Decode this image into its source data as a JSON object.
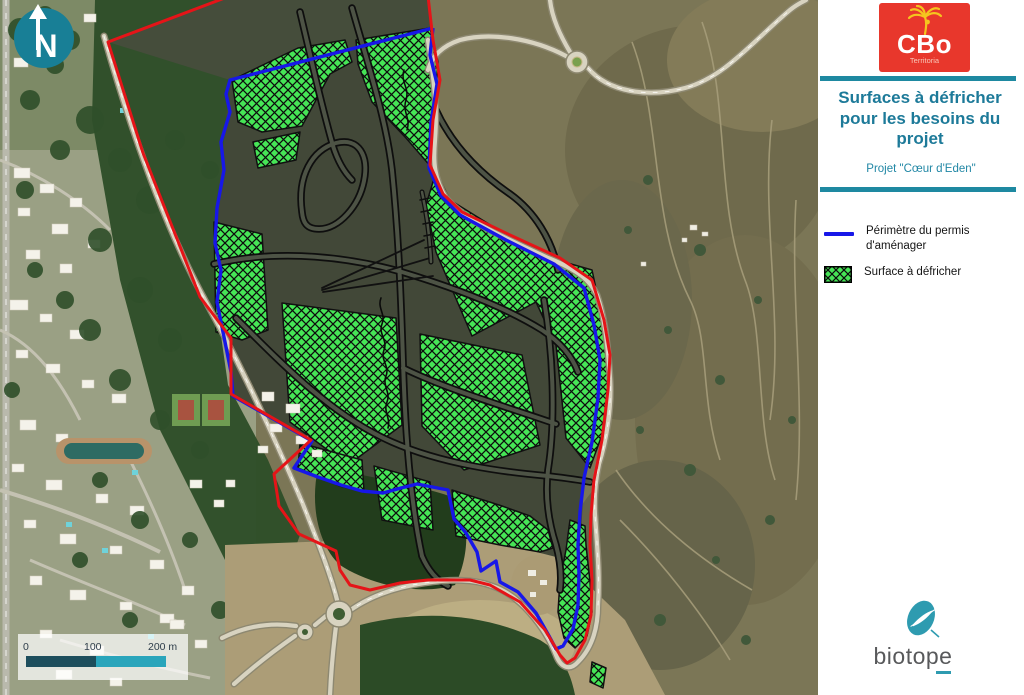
{
  "map": {
    "north_label": "N",
    "scale_bar": {
      "tick_0": "0",
      "tick_100": "100",
      "tick_200": "200 m"
    }
  },
  "sidebar": {
    "cbo_logo": {
      "name": "CBo",
      "tagline": "Territoria"
    },
    "title": "Surfaces à défricher pour les besoins du projet",
    "subtitle": "Projet \"Cœur d'Eden\"",
    "legend": {
      "perimeter_label": "Périmètre du permis d'aménager",
      "clearing_label": "Surface à défricher"
    },
    "biotope_logo": {
      "name": "biotope"
    }
  },
  "colors": {
    "accent_teal": "#1E89A1",
    "title_text": "#1D7A99",
    "perimeter_blue": "#1717E8",
    "boundary_red": "#E51418",
    "clearing_green": "#46E556",
    "cbo_red": "#E8372C",
    "cbo_yellow": "#F5C51E",
    "biotope_teal": "#2E9BB0"
  }
}
